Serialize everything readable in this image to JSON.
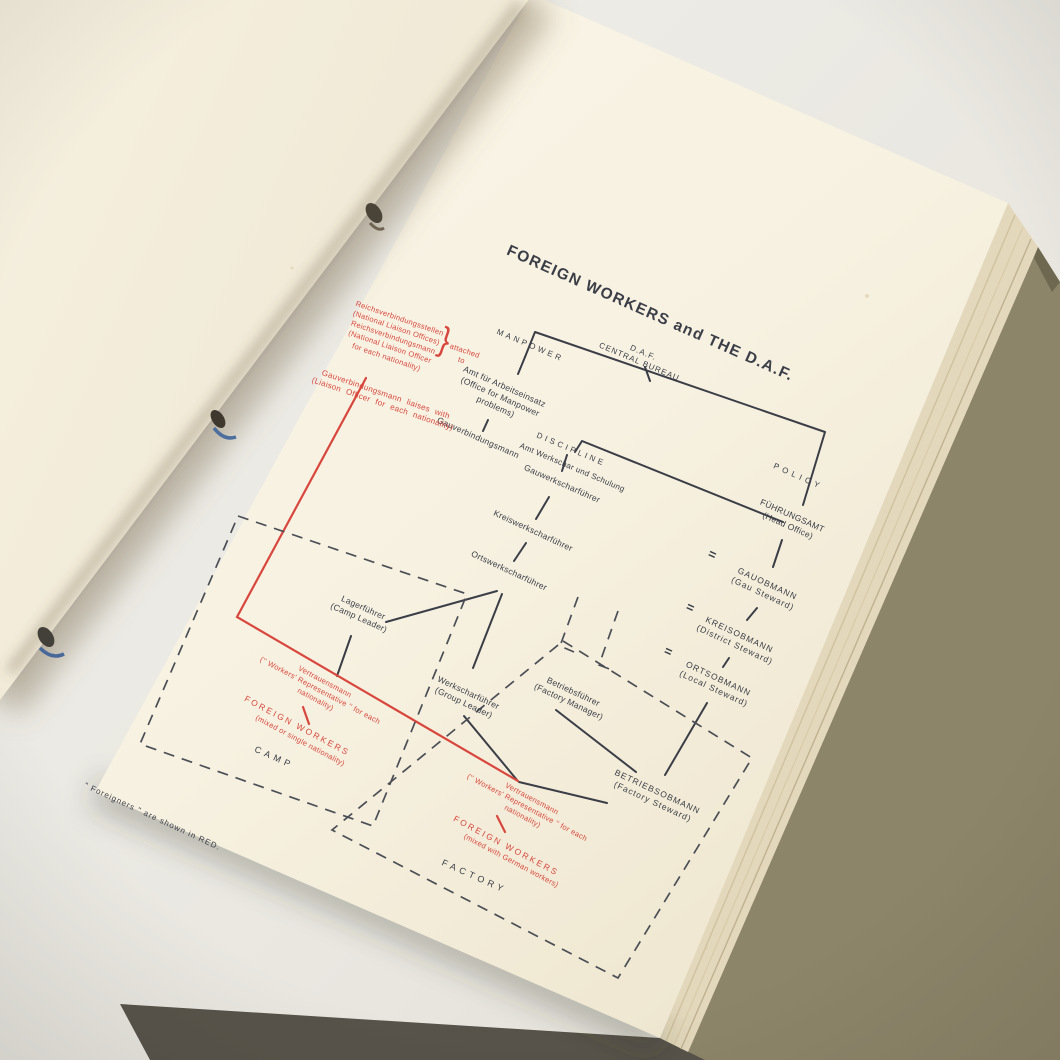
{
  "title": "FOREIGN WORKERS and THE D.A.F.",
  "daf": {
    "central_bureau": "D.A.F.\nCENTRAL BUREAU",
    "manpower": "MANPOWER",
    "policy": "POLICY",
    "fuehrungsamt": "FÜHRUNGSAMT\n(Head Office)",
    "amt_arbeitseinsatz": "Amt für Arbeitseinsatz\n(Office for Manpower\nproblems)",
    "gauverbindungsmann_daf": "Gauverbindungsmann",
    "discipline": "DISCIPLINE",
    "amt_werkschar": "Amt Werkschar und Schulung",
    "gauwerkscharfuehrer": "Gauwerkscharführer",
    "kreiswerkscharfuehrer": "Kreiswerkscharführer",
    "ortswerkscharfuehrer": "Ortswerkscharführer",
    "lagerfuehrer": "Lagerführer\n(Camp Leader)",
    "werkscharfuehrer": "Werkscharführer\n(Group Leader)",
    "betriebsfuehrer": "Betriebsführer\n(Factory Manager)",
    "gauobmann": "GAUOBMANN\n(Gau Steward)",
    "kreisobmann": "KREISOBMANN\n(District Steward)",
    "ortsobmann": "ORTSOBMANN\n(Local Steward)",
    "betriebsobmann": "BETRIEBSOBMANN\n(Factory Steward)",
    "equals_sign": "="
  },
  "foreign_red": {
    "reichs_block": "Reichsverbindungsstellen\n(National Liaison Offices)\nReichsverbindungsmann\n(National Liaison Officer\nfor each nationality)",
    "brace": "}",
    "attached_to": "attached\nto",
    "gau_liaison": "Gauverbindungsmann liaises with\n(Liaison Officer for each nationality)",
    "camp_vertrauensmann": "Vertrauensmann\n('' Workers' Representative '' for each\nnationality)",
    "camp_foreign_workers": "FOREIGN WORKERS",
    "camp_foreign_workers_sub": "(mixed or single nationality)",
    "factory_vertrauensmann": "Vertrauensmann\n('' Workers' Representative '' for each\nnationality)",
    "factory_foreign_workers": "FOREIGN WORKERS",
    "factory_foreign_workers_sub": "(mixed with German workers)"
  },
  "zones": {
    "camp": "CAMP",
    "factory": "FACTORY"
  },
  "footnote": "\" Foreigners \" are shown in RED.",
  "colors": {
    "red": "#d8473e",
    "ink": "#3b3e47",
    "paper": "#f7f1e1"
  }
}
